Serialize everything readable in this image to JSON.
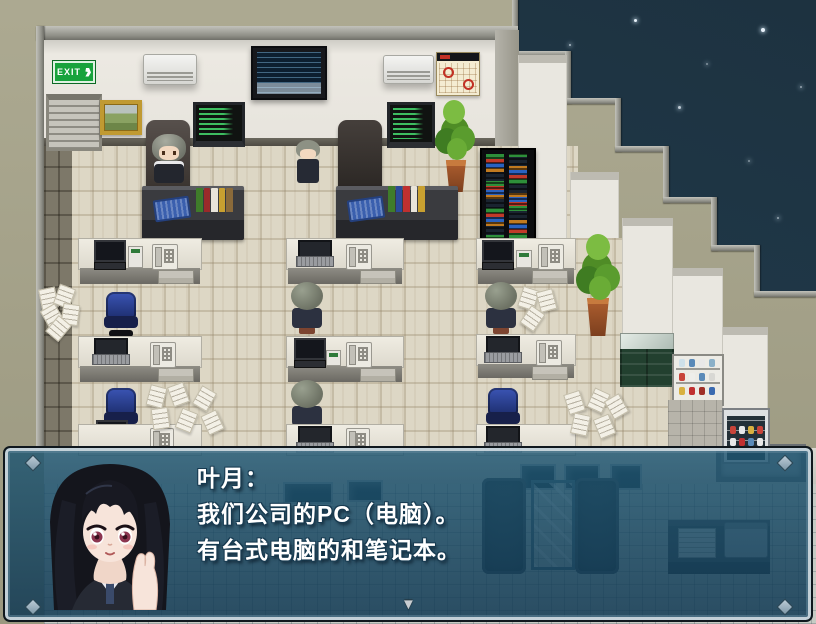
{
  "window": {
    "width": 816,
    "height": 624
  },
  "scene": {
    "setting": "rpg-office-interior-night",
    "exit_sign": "EXIT",
    "objects": [
      "exit-sign",
      "roller-shutter-window",
      "framed-painting",
      "air-conditioner",
      "wall-tv",
      "code-monitor",
      "wall-calendar",
      "potted-plant",
      "server-rack",
      "executive-desk",
      "office-desk",
      "desk-phone",
      "laptop",
      "desktop-computer",
      "office-chair-blue",
      "office-chair-black",
      "scattered-papers",
      "kitchen-counter",
      "dish-shelf",
      "drink-fridge",
      "sofa",
      "glass-table",
      "printer-desk"
    ],
    "characters": {
      "seated_front_count": 1,
      "standing_count": 1,
      "seated_back_count": 3
    },
    "colors": {
      "sky_top": "#1d3240",
      "sky_bottom": "#4a5147",
      "exterior_wall": "#a6a389",
      "wall_trim": "#9d9d96",
      "interior_wall": "#eae8e1",
      "floor": "#ddd7c5",
      "walkway": "#7d7869",
      "exit_green": "#18a33c"
    }
  },
  "dialog": {
    "speaker": "叶月：",
    "lines": [
      "我们公司的PC（电脑）。",
      "有台式电脑的和笔记本。"
    ],
    "portrait": "anime-girl-long-black-hair",
    "continue_indicator": "▼",
    "colors": {
      "fill": "rgba(25,78,108,0.84)",
      "border_light": "#cdd8de",
      "border_dark": "#0f171d",
      "text": "#ffffff"
    }
  }
}
